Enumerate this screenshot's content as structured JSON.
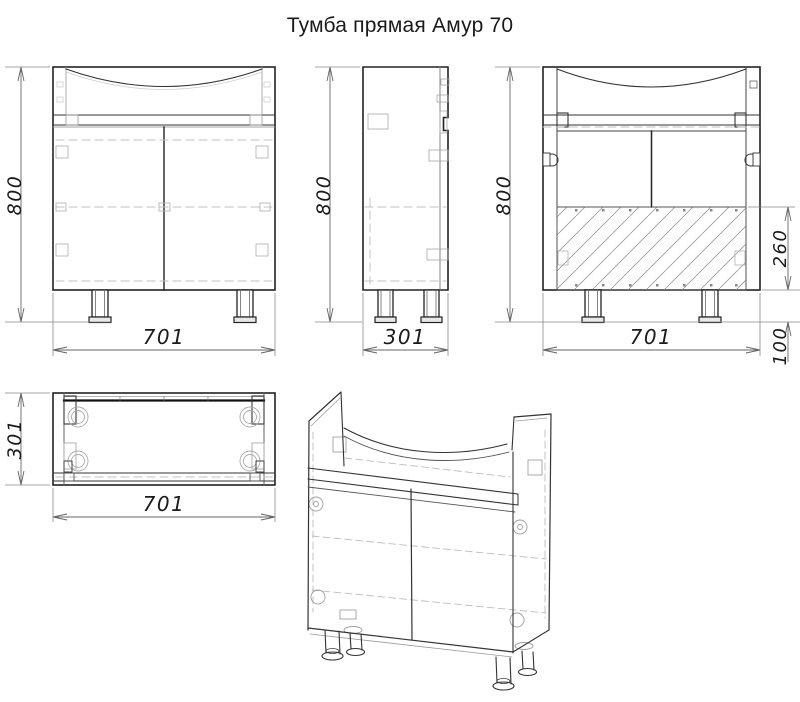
{
  "title": "Тумба прямая Амур 70",
  "dimensions": {
    "front_height": "800",
    "front_width": "701",
    "side_height": "800",
    "side_depth": "301",
    "back_height": "800",
    "back_width": "701",
    "back_panel_height": "260",
    "back_leg_height": "100",
    "top_depth": "301",
    "top_width": "701"
  },
  "colors": {
    "line": "#222222",
    "hidden_line": "#c0c0c0",
    "hatch": "#9a9a9a",
    "background": "#ffffff",
    "text": "#1a1a1a"
  }
}
